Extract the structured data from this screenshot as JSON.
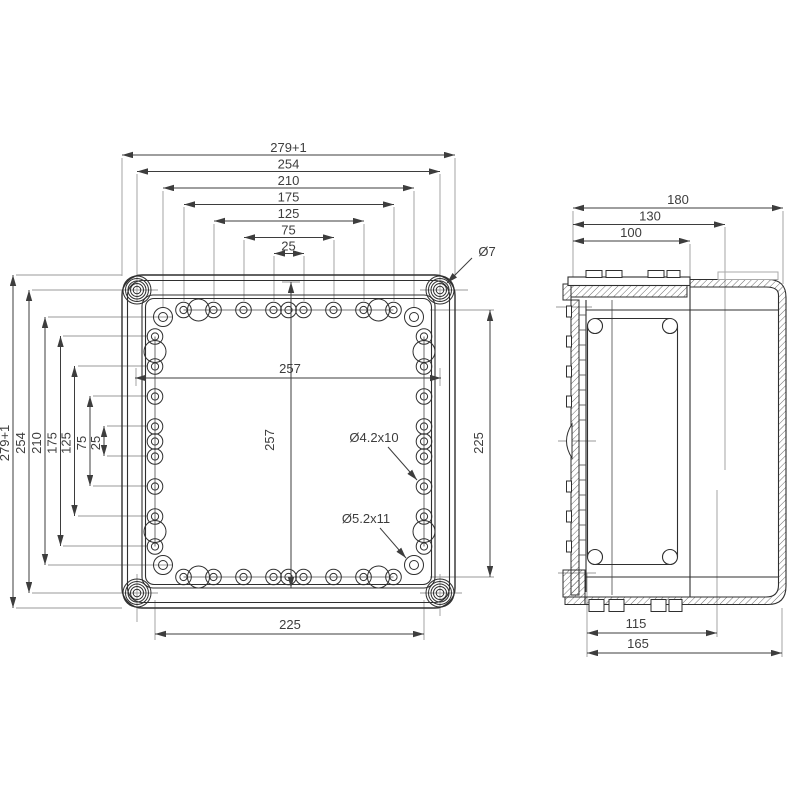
{
  "drawing": {
    "plan": {
      "top_dims": [
        "279+1",
        "254",
        "210",
        "175",
        "125",
        "75",
        "25"
      ],
      "left_dims": [
        "279+1",
        "254",
        "210",
        "175",
        "125",
        "75",
        "25"
      ],
      "width_inner": "257",
      "height_inner": "257",
      "height_holes": "225",
      "width_holes": "225",
      "callout_cover_hole": "Ø7",
      "callout_small_holes": "Ø4.2x10",
      "callout_corner_holes": "Ø5.2x11"
    },
    "side": {
      "top_dims": [
        "180",
        "130",
        "100"
      ],
      "bottom_dims": [
        "115",
        "165"
      ]
    }
  }
}
